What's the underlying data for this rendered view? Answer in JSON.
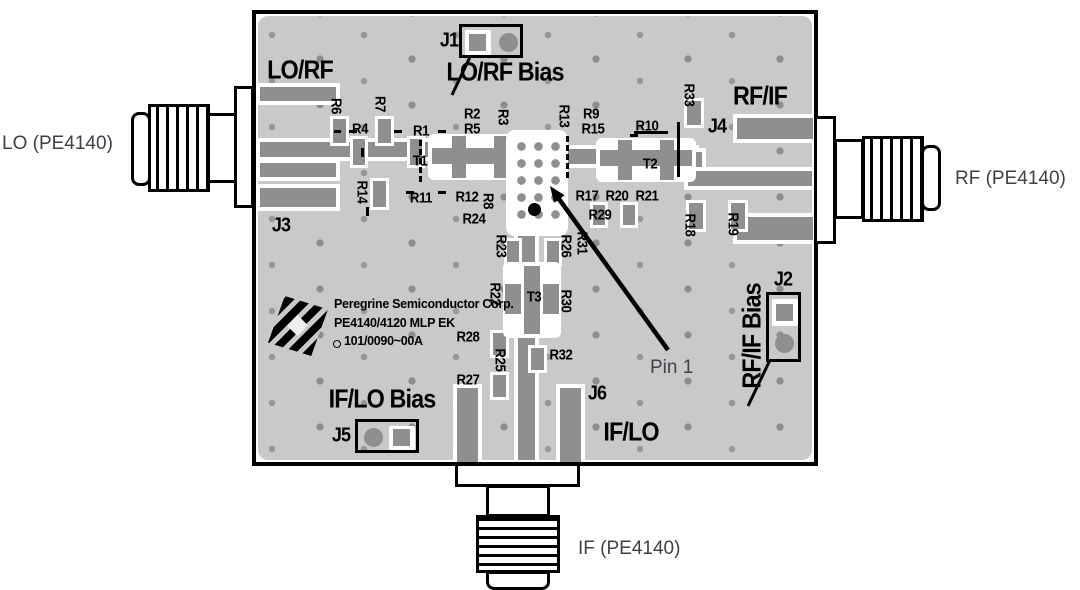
{
  "diagram": {
    "connectors": {
      "left": "LO (PE4140)",
      "right": "RF (PE4140)",
      "bottom": "IF (PE4140)"
    },
    "pin1_label": "Pin 1",
    "ports": {
      "lo_rf": "LO/RF",
      "rf_if": "RF/IF",
      "if_lo": "IF/LO",
      "lo_rf_bias": "LO/RF Bias",
      "rf_if_bias": "RF/IF Bias",
      "if_lo_bias": "IF/LO Bias"
    },
    "jumpers": {
      "j1": "J1",
      "j2": "J2",
      "j3": "J3",
      "j4": "J4",
      "j5": "J5",
      "j6": "J6"
    },
    "logo": {
      "line1": "Peregrine Semiconductor Corp.",
      "line2": "PE4140/4120 MLP EK",
      "line3": "101/0090~00A"
    },
    "refdes": [
      {
        "label": "R1",
        "x": 421,
        "y": 131,
        "o": "h"
      },
      {
        "label": "R2",
        "x": 472,
        "y": 114,
        "o": "h"
      },
      {
        "label": "R3",
        "x": 503,
        "y": 117,
        "o": "v"
      },
      {
        "label": "R4",
        "x": 360,
        "y": 129,
        "o": "h"
      },
      {
        "label": "R5",
        "x": 472,
        "y": 129,
        "o": "h"
      },
      {
        "label": "R6",
        "x": 336,
        "y": 106,
        "o": "v"
      },
      {
        "label": "R7",
        "x": 380,
        "y": 104,
        "o": "v"
      },
      {
        "label": "R8",
        "x": 488,
        "y": 201,
        "o": "v"
      },
      {
        "label": "R9",
        "x": 591,
        "y": 114,
        "o": "h"
      },
      {
        "label": "R10",
        "x": 647,
        "y": 126,
        "o": "h"
      },
      {
        "label": "R11",
        "x": 421,
        "y": 198,
        "o": "h"
      },
      {
        "label": "R12",
        "x": 467,
        "y": 197,
        "o": "h"
      },
      {
        "label": "R13",
        "x": 564,
        "y": 116,
        "o": "v"
      },
      {
        "label": "R14",
        "x": 362,
        "y": 192,
        "o": "v"
      },
      {
        "label": "R15",
        "x": 593,
        "y": 129,
        "o": "h"
      },
      {
        "label": "R17",
        "x": 587,
        "y": 196,
        "o": "h"
      },
      {
        "label": "R18",
        "x": 690,
        "y": 225,
        "o": "v"
      },
      {
        "label": "R19",
        "x": 733,
        "y": 224,
        "o": "v"
      },
      {
        "label": "R20",
        "x": 617,
        "y": 196,
        "o": "h"
      },
      {
        "label": "R21",
        "x": 647,
        "y": 196,
        "o": "h"
      },
      {
        "label": "R22",
        "x": 495,
        "y": 294,
        "o": "v"
      },
      {
        "label": "R23",
        "x": 501,
        "y": 246,
        "o": "v"
      },
      {
        "label": "R24",
        "x": 474,
        "y": 219,
        "o": "h"
      },
      {
        "label": "R25",
        "x": 500,
        "y": 360,
        "o": "v"
      },
      {
        "label": "R26",
        "x": 566,
        "y": 246,
        "o": "v"
      },
      {
        "label": "R27",
        "x": 468,
        "y": 380,
        "o": "h"
      },
      {
        "label": "R28",
        "x": 468,
        "y": 337,
        "o": "h"
      },
      {
        "label": "R29",
        "x": 600,
        "y": 215,
        "o": "h"
      },
      {
        "label": "R30",
        "x": 566,
        "y": 301,
        "o": "v"
      },
      {
        "label": "R31",
        "x": 582,
        "y": 243,
        "o": "v"
      },
      {
        "label": "R32",
        "x": 561,
        "y": 355,
        "o": "h"
      },
      {
        "label": "R33",
        "x": 689,
        "y": 95,
        "o": "v"
      },
      {
        "label": "T1",
        "x": 420,
        "y": 161,
        "o": "h"
      },
      {
        "label": "T2",
        "x": 650,
        "y": 164,
        "o": "h"
      },
      {
        "label": "T3",
        "x": 534,
        "y": 297,
        "o": "h"
      }
    ],
    "colors": {
      "board": "#c9c9c9",
      "copper": "#8f8f8f",
      "silkscreen": "#000000",
      "annotation_text": "#3d4248",
      "background": "#ffffff"
    }
  }
}
